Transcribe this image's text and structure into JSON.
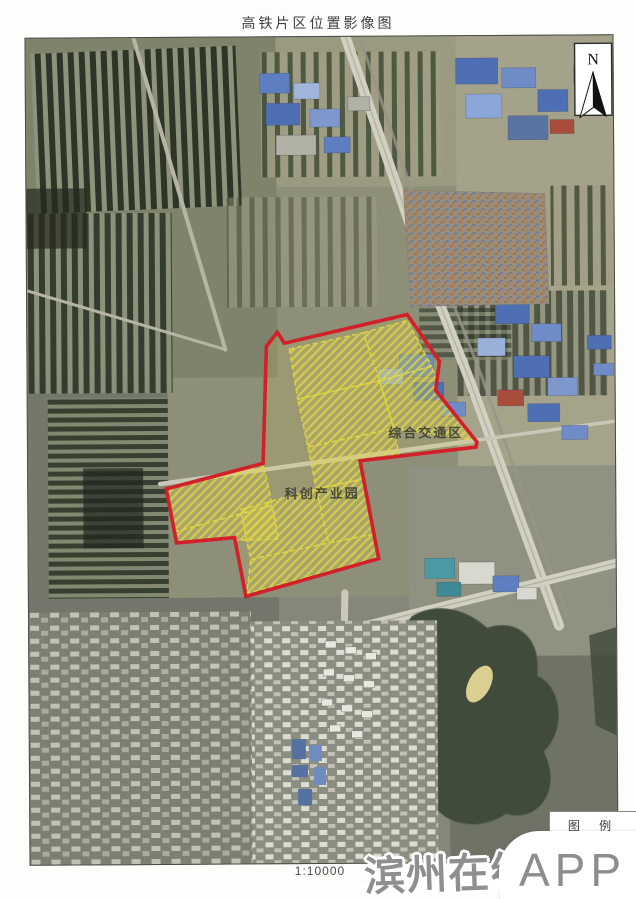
{
  "page": {
    "title": "高铁片区位置影像图",
    "scale_label": "1:10000"
  },
  "map": {
    "north_label": "N",
    "zone_labels": [
      {
        "text": "综合交通区"
      },
      {
        "text": "科创产业园"
      }
    ],
    "boundary_color": "#d1202a",
    "parcel_line_color": "#e3d83e"
  },
  "legend": {
    "title": "图 例",
    "swatch_color": "#c6375a"
  },
  "watermark": {
    "site_name": "滨州在线",
    "badge": "APP"
  }
}
